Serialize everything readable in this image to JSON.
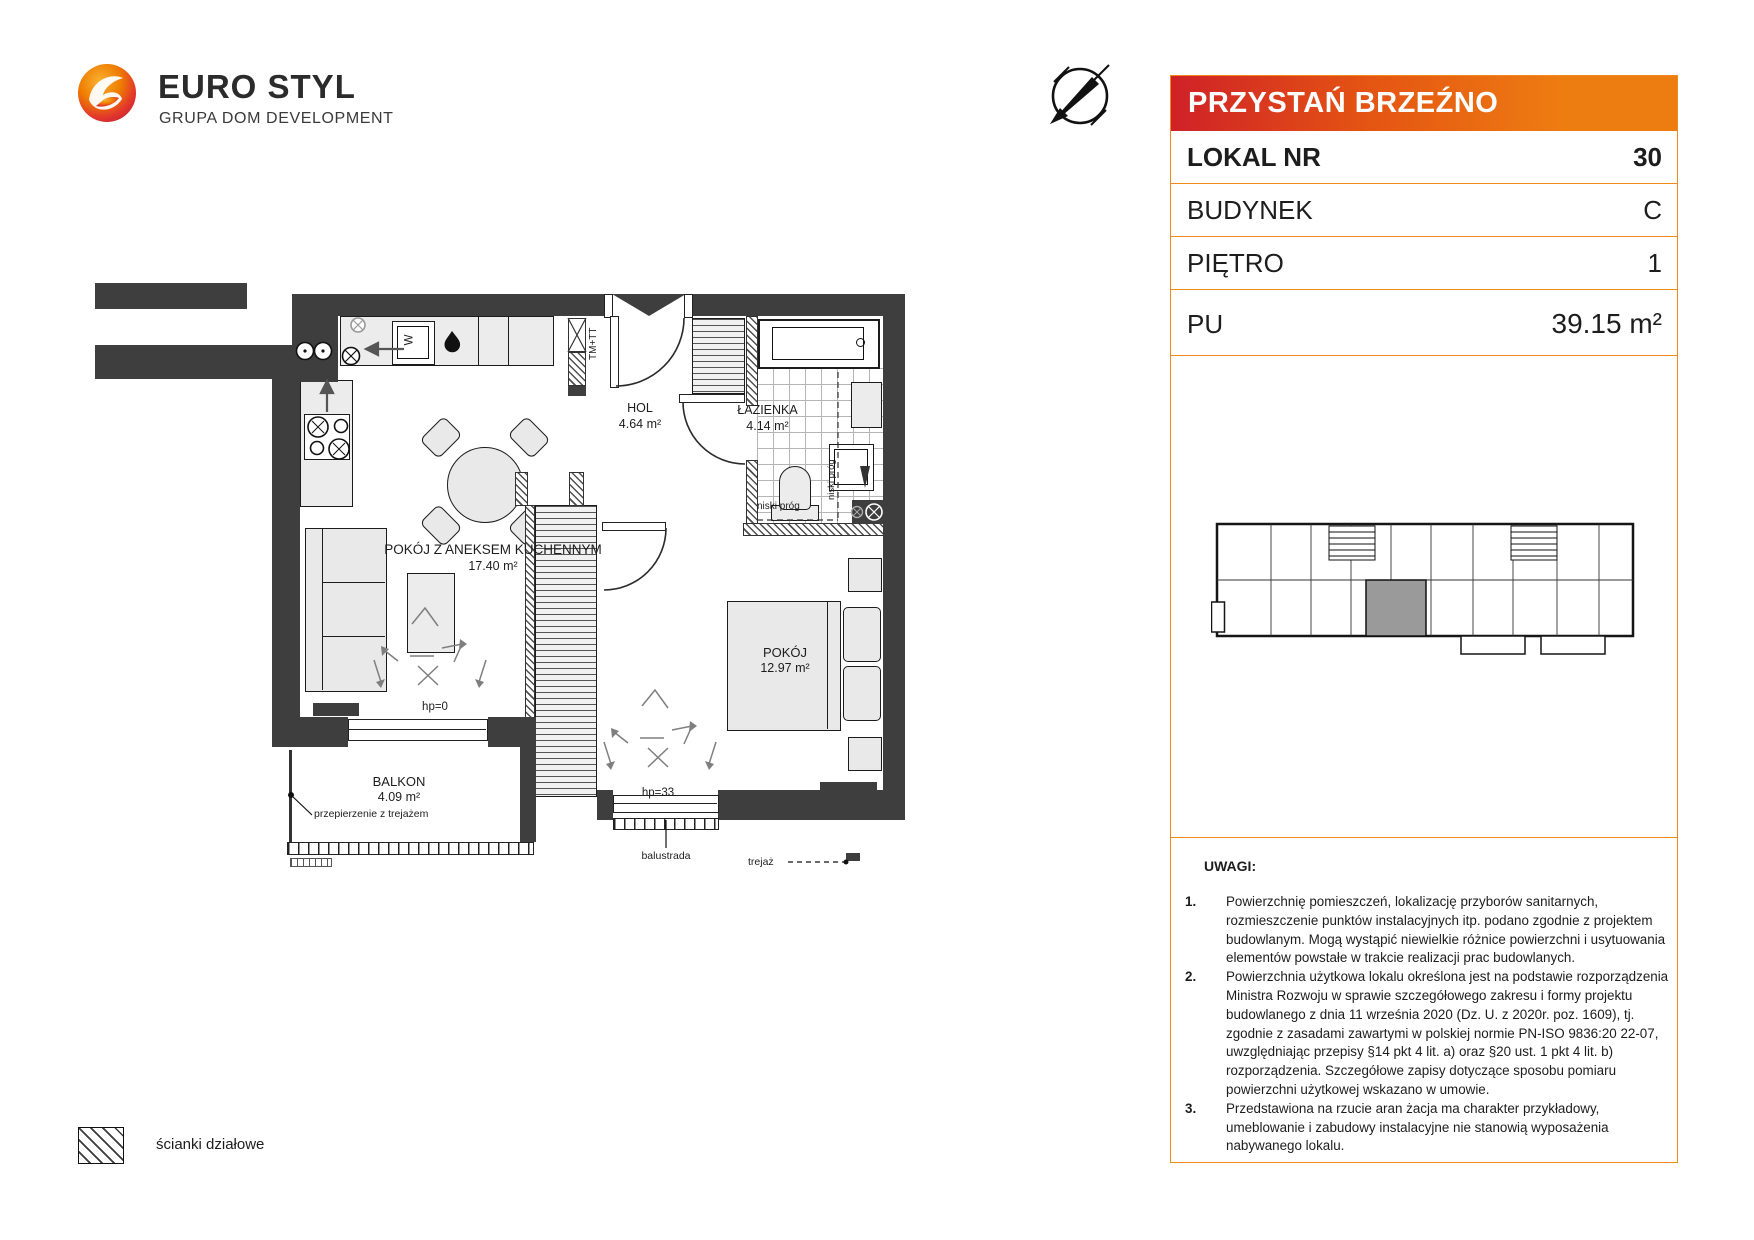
{
  "logo": {
    "name": "EURO STYL",
    "tagline": "GRUPA DOM DEVELOPMENT"
  },
  "project_header": {
    "title": "PRZYSTAŃ BRZEŹNO"
  },
  "unit_table": {
    "rows": [
      {
        "label": "LOKAL NR",
        "value": "30"
      },
      {
        "label": "BUDYNEK",
        "value": "C"
      },
      {
        "label": "PIĘTRO",
        "value": "1"
      },
      {
        "label": "PU",
        "value": "39.15 m²"
      }
    ]
  },
  "floor_plan": {
    "rooms": {
      "living": {
        "name": "POKÓJ Z ANEKSEM KUCHENNYM",
        "area": "17.40 m²"
      },
      "hall": {
        "name": "HOL",
        "area": "4.64 m²"
      },
      "bathroom": {
        "name": "ŁAZIENKA",
        "area": "4.14 m²"
      },
      "bedroom": {
        "name": "POKÓJ",
        "area": "12.97 m²"
      },
      "balcony": {
        "name": "BALKON",
        "area": "4.09 m²"
      }
    },
    "annotations": {
      "hp0": "hp=0",
      "hp33": "hp=33",
      "balustrade": "balustrada",
      "trellis": "trejaż",
      "partition_trellis": "przepierzenie z trejażem",
      "low_threshold_1": "niski próg",
      "low_threshold_2": "niski próg",
      "shaft": "TM+TT",
      "washer_letter": "W"
    }
  },
  "legend": {
    "partition_walls": "ścianki działowe"
  },
  "notes": {
    "title": "UWAGI:",
    "items": [
      {
        "no": "1.",
        "text": "Powierzchnię pomieszczeń, lokalizację przyborów sanitarnych, rozmieszczenie punktów instalacyjnych itp. podano zgodnie z projektem budowlanym. Mogą wystąpić niewielkie różnice powierzchni i usytuowania elementów powstałe w trakcie realizacji prac budowlanych."
      },
      {
        "no": "2.",
        "text": "Powierzchnia użytkowa lokalu określona jest na podstawie rozporządzenia Ministra Rozwoju w sprawie szczegółowego zakresu i formy projektu budowlanego z dnia 11 września 2020 (Dz. U. z 2020r. poz. 1609), tj. zgodnie z zasadami zawartymi w polskiej normie PN-ISO 9836:20 22-07, uwzględniając przepisy §14 pkt 4 lit. a) oraz §20 ust. 1 pkt 4 lit. b) rozporządzenia. Szczegółowe zapisy dotyczące sposobu pomiaru powierzchni użytkowej wskazano w umowie."
      },
      {
        "no": "3.",
        "text": "Przedstawiona na rzucie aran żacja ma charakter przykładowy, umeblowanie i zabudowy instalacyjne nie stanowią wyposażenia nabywanego lokalu."
      }
    ]
  },
  "colors": {
    "wall": "#3e3e3e",
    "accent_red": "#d2232a",
    "accent_orange": "#ef7d00",
    "table_border": "#ef8a1d",
    "highlight_unit": "#9a9a9a"
  }
}
